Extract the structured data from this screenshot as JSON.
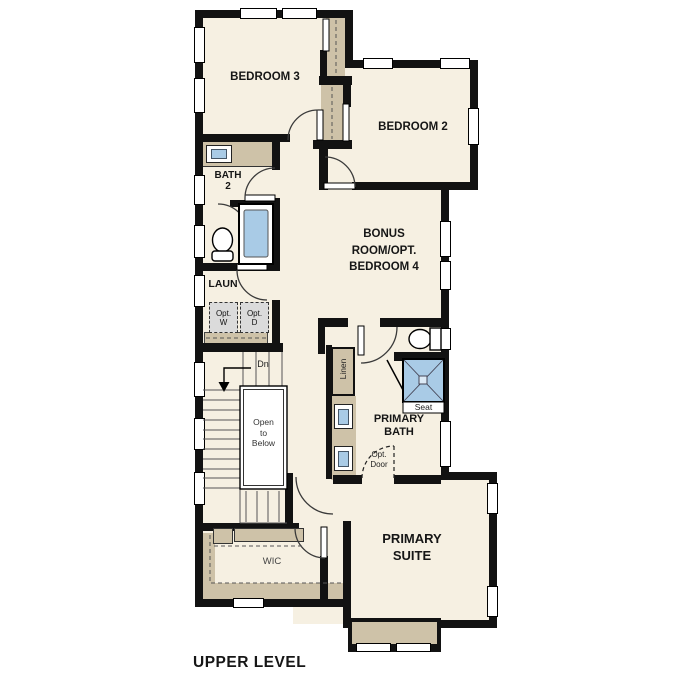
{
  "plan_title": "UPPER LEVEL",
  "colors": {
    "paper": "#ffffff",
    "floor": "#f6f0e2",
    "wall": "#121212",
    "cabinet-tan": "#cec2a8",
    "fixture-blue": "#a9cbe6",
    "appliance-gray": "#dbdbdb",
    "line": "#444444"
  },
  "rooms": {
    "bedroom3": "BEDROOM 3",
    "bedroom2": "BEDROOM 2",
    "bath2": [
      "BATH",
      "2"
    ],
    "laundry": "LAUN",
    "bonus": [
      "BONUS",
      "ROOM/OPT.",
      "BEDROOM 4"
    ],
    "primary_bath": [
      "PRIMARY",
      "BATH"
    ],
    "primary_suite": [
      "PRIMARY",
      "SUITE"
    ],
    "wic": "WIC"
  },
  "annotations": {
    "open_to_below": [
      "Open",
      "to",
      "Below"
    ],
    "down": "Dn",
    "linen": "Linen",
    "seat": "Seat",
    "opt_washer": [
      "Opt.",
      "W"
    ],
    "opt_dryer": [
      "Opt.",
      "D"
    ],
    "opt_door": [
      "Opt.",
      "Door"
    ]
  }
}
